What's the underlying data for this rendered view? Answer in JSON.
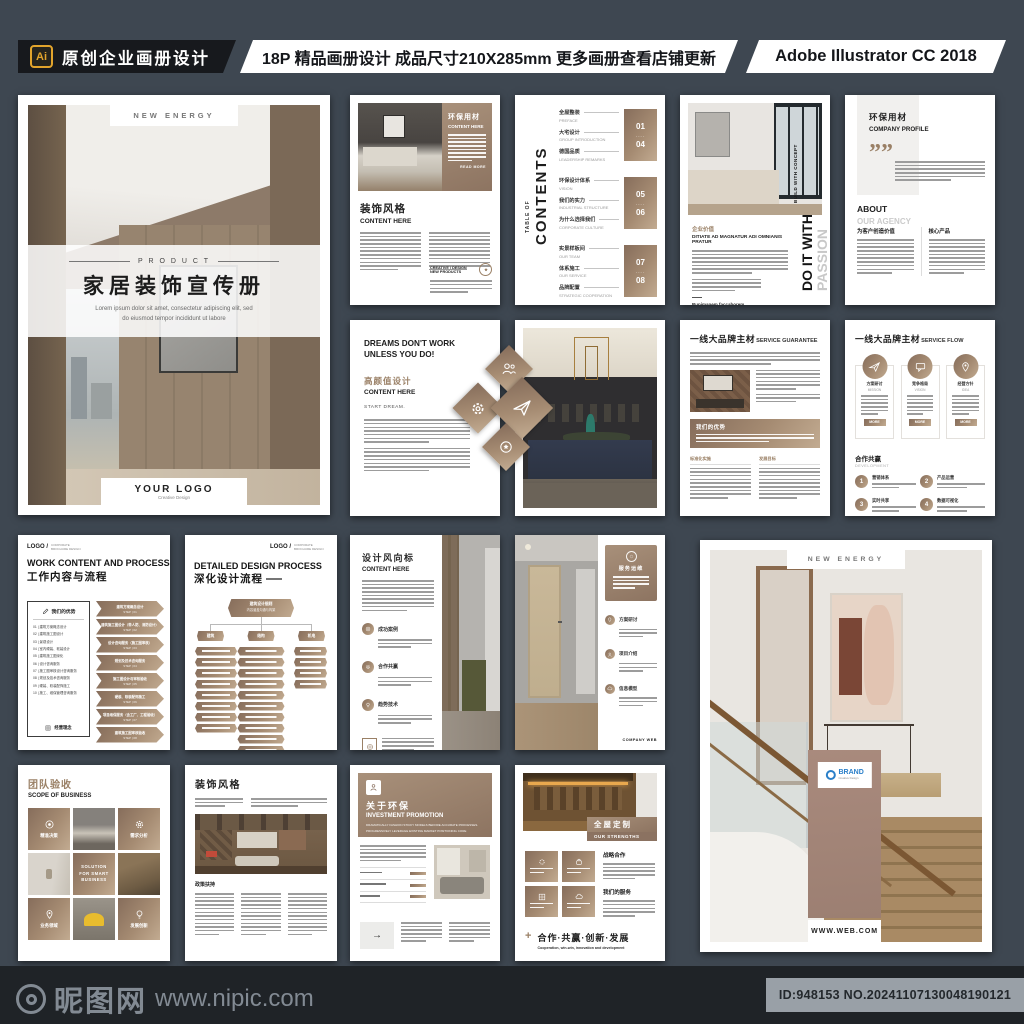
{
  "palette": {
    "bg": "#3e4751",
    "accent_dark": "#8b7261",
    "accent_light": "#c2ab91",
    "header_black": "#17191d",
    "ai_gold": "#e2a42c",
    "footer_bg": "#1f2327",
    "footer_text": "#828a93",
    "id_box_bg": "#99a0a7"
  },
  "header": {
    "ai_badge": "Ai",
    "shop_title": "原创企业画册设计",
    "promo_text": "18P 精品画册设计 成品尺寸210X285mm 更多画册查看店铺更新",
    "software": "Adobe Illustrator CC 2018"
  },
  "footer": {
    "site_name": "昵图网",
    "site_url": "www.nipic.com",
    "image_id": "ID:948153 NO.20241107130048190121"
  },
  "cover": {
    "tag": "NEW ENERGY",
    "kicker": "P R O D U C T",
    "title": "家居装饰宣传册",
    "subtitle_line1": "Lorem ipsum dolor sit amet, consectetur adipiscing elit, sed",
    "subtitle_line2": "do eiusmod tempor incididunt ut labore",
    "logo": "YOUR LOGO",
    "logo_sub": "Creative Design"
  },
  "decor_page": {
    "panel_title_cn": "环保用材",
    "panel_title_en": "CONTENT HERE",
    "read_more": "READ MORE",
    "title_cn": "装饰风格",
    "title_en": "CONTENT HERE",
    "side_line1": "CREATIVE / DESIGN",
    "side_line2": "NEW PRODUCTS"
  },
  "contents_page": {
    "vertical_small": "TABLE OF",
    "vertical_big": "CONTENTS",
    "groups": [
      {
        "from": "01",
        "to": "04",
        "items": [
          {
            "cn": "全屋整装",
            "en": "PREFACE"
          },
          {
            "cn": "大宅设计",
            "en": "GROUP INTRODUCTION"
          },
          {
            "cn": "德国品质",
            "en": "LEADERSHIP REMARKS"
          }
        ]
      },
      {
        "from": "05",
        "to": "06",
        "items": [
          {
            "cn": "环保设计体系",
            "en": "VISION"
          },
          {
            "cn": "我们的实力",
            "en": "INDUSTRIAL STRUCTURE"
          },
          {
            "cn": "为什么选择我们",
            "en": "CORPORATE CULTURE"
          }
        ]
      },
      {
        "from": "07",
        "to": "08",
        "items": [
          {
            "cn": "实景样板间",
            "en": "OUR TEAM"
          },
          {
            "cn": "体系施工",
            "en": "OUR SERVICE"
          },
          {
            "cn": "品牌配置",
            "en": "STRATEGIC COOPERATION"
          }
        ]
      }
    ]
  },
  "passion_page": {
    "vertical_small": "BUILD WITH CONCEPT",
    "vertical_big1": "DO IT WITH",
    "vertical_big2": "PASSION",
    "heading_cn": "企业价值",
    "heading_en": "DITIATE AD MAGNATUR ADI OMNIANIS PRATUR",
    "sign_name": "Runimanem faccaborem",
    "sign_sub": "sum voloruptat"
  },
  "profile_page": {
    "title_cn": "环保用材",
    "title_en": "COMPANY PROFILE",
    "quote_mark": "””",
    "about_bold": "ABOUT",
    "about_light": "OUR AGENCY",
    "col1_title": "为客户创造价值",
    "col2_title": "核心产品"
  },
  "dreams_page": {
    "line1": "DREAMS DON'T WORK",
    "line2": "UNLESS YOU DO!",
    "heading_cn": "高颜值设计",
    "heading_en": "CONTENT HERE",
    "start": "START DREAM."
  },
  "guarantee_page": {
    "title_cn": "一线大品牌主材",
    "title_en": "SERVICE GUARANTEE",
    "band_title": "我们的优势",
    "col1_title": "标准化实施",
    "col2_title": "发展目标"
  },
  "flow_page": {
    "title_cn": "一线大品牌主材",
    "title_en": "SERVICE FLOW",
    "cards": [
      {
        "cn": "方案研讨",
        "en": "MISSION",
        "more": "MORE"
      },
      {
        "cn": "竞争格局",
        "en": "VISION",
        "more": "MORE"
      },
      {
        "cn": "经营方针",
        "en": "IDEA",
        "more": "MORE"
      }
    ],
    "section_cn": "合作共赢",
    "section_en": "DEVELOPMENT",
    "items": [
      {
        "num": "1",
        "label": "营销体系"
      },
      {
        "num": "2",
        "label": "产品运营"
      },
      {
        "num": "3",
        "label": "实时共享"
      },
      {
        "num": "4",
        "label": "数据可视化"
      }
    ]
  },
  "work_page": {
    "logo": "LOGO /",
    "logo_sub": "CORPORATE BROCHURE DESIGN",
    "title_en": "WORK CONTENT AND PROCESS",
    "title_cn": "工作内容与流程",
    "box_title": "我们的优势",
    "list": [
      "01 | 建筑方案概念设计",
      "02 | 建筑施工图设计",
      "03 | 景观设计",
      "04 | 室内硬装、软装设计",
      "05 | 建筑施工图深化",
      "06 | 设计咨询服务",
      "07 | 施工图审核设计咨询服务",
      "08 | 规划及技术咨询服务",
      "09 | 硬装、软装配饰施工",
      "10 | 施工、维保管理咨询服务"
    ],
    "box_footer": "经营理念",
    "steps": [
      {
        "label": "建筑方案概念设计",
        "step": "STEP | 01"
      },
      {
        "label": "建筑施工图设计（带人防、消防设计）",
        "step": "STEP | 02"
      },
      {
        "label": "设计咨询服务（施工图审核）",
        "step": "STEP | 03"
      },
      {
        "label": "规划及技术咨询服务",
        "step": "STEP | 04"
      },
      {
        "label": "施工图设计与审核验收",
        "step": "STEP | 05"
      },
      {
        "label": "硬装、软装配饰施工",
        "step": "STEP | 06"
      },
      {
        "label": "项目维保服务（含工厂、工程验收）",
        "step": "STEP | 07"
      },
      {
        "label": "建筑施工图审核验收",
        "step": "STEP | 08"
      }
    ]
  },
  "detail_page": {
    "logo": "LOGO /",
    "logo_sub": "CORPORATE BROCHURE DESIGN",
    "title_en": "DETAILED DESIGN PROCESS",
    "title_cn": "深化设计流程",
    "root_line1": "建筑设计细则",
    "root_line2": "内容涵盖沟通与构架",
    "branches": [
      "建筑",
      "结构",
      "机电"
    ]
  },
  "vane_page": {
    "title_cn": "设计风向标",
    "title_en": "CONTENT HERE",
    "items": [
      "成功案例",
      "合作共赢",
      "趋势技术"
    ]
  },
  "service_page": {
    "block_title": "服务运维",
    "items": [
      "方案研讨",
      "项目介绍",
      "信息模型"
    ],
    "footer": "COMPANY WEB"
  },
  "back_cover": {
    "tag": "NEW ENERGY",
    "brand": "BRAND",
    "brand_sub": "Creative Design",
    "url": "WWW.WEB.COM"
  },
  "team_page": {
    "title_cn": "团队验收",
    "title_en": "SCOPE OF BUSINESS",
    "tiles": [
      "精准决策",
      "需求分析",
      "SOLUTION FOR SMART BUSINESS",
      "业务领域",
      "发展创新"
    ]
  },
  "decor2_page": {
    "title_cn": "装饰风格",
    "section": "政策扶持"
  },
  "invest_page": {
    "title_cn": "关于环保",
    "title_en": "INVESTMENT PROMOTION",
    "desc1": "DRAMATICALLY FASHION STICKY MODELS BEFORE ACCURATE PROCESSES.",
    "desc2": "PROGRESSIVELY LEVERAGE EXISTING MARKET POSITIONING CORE"
  },
  "custom_page": {
    "label_cn": "全屋定制",
    "label_en": "OUR STRENGTHS",
    "right_title1": "战略合作",
    "right_title2": "我们的服务",
    "plus": "+",
    "slogan_cn": "合作·共赢·创新·发展",
    "slogan_en": "Cooperation, win-win, innovation and development"
  },
  "icons": {
    "diamonds": [
      "people-icon",
      "gear-icon",
      "paper-plane-icon",
      "medal-icon"
    ],
    "flow_cards": [
      "paper-plane-icon",
      "chat-icon",
      "pin-icon"
    ],
    "team_tiles": [
      "target-icon",
      "gear-icon",
      "pin-icon",
      "bulb-icon"
    ],
    "custom_squares": [
      "gear-icon",
      "bag-icon",
      "grid-icon",
      "cloud-icon"
    ]
  }
}
